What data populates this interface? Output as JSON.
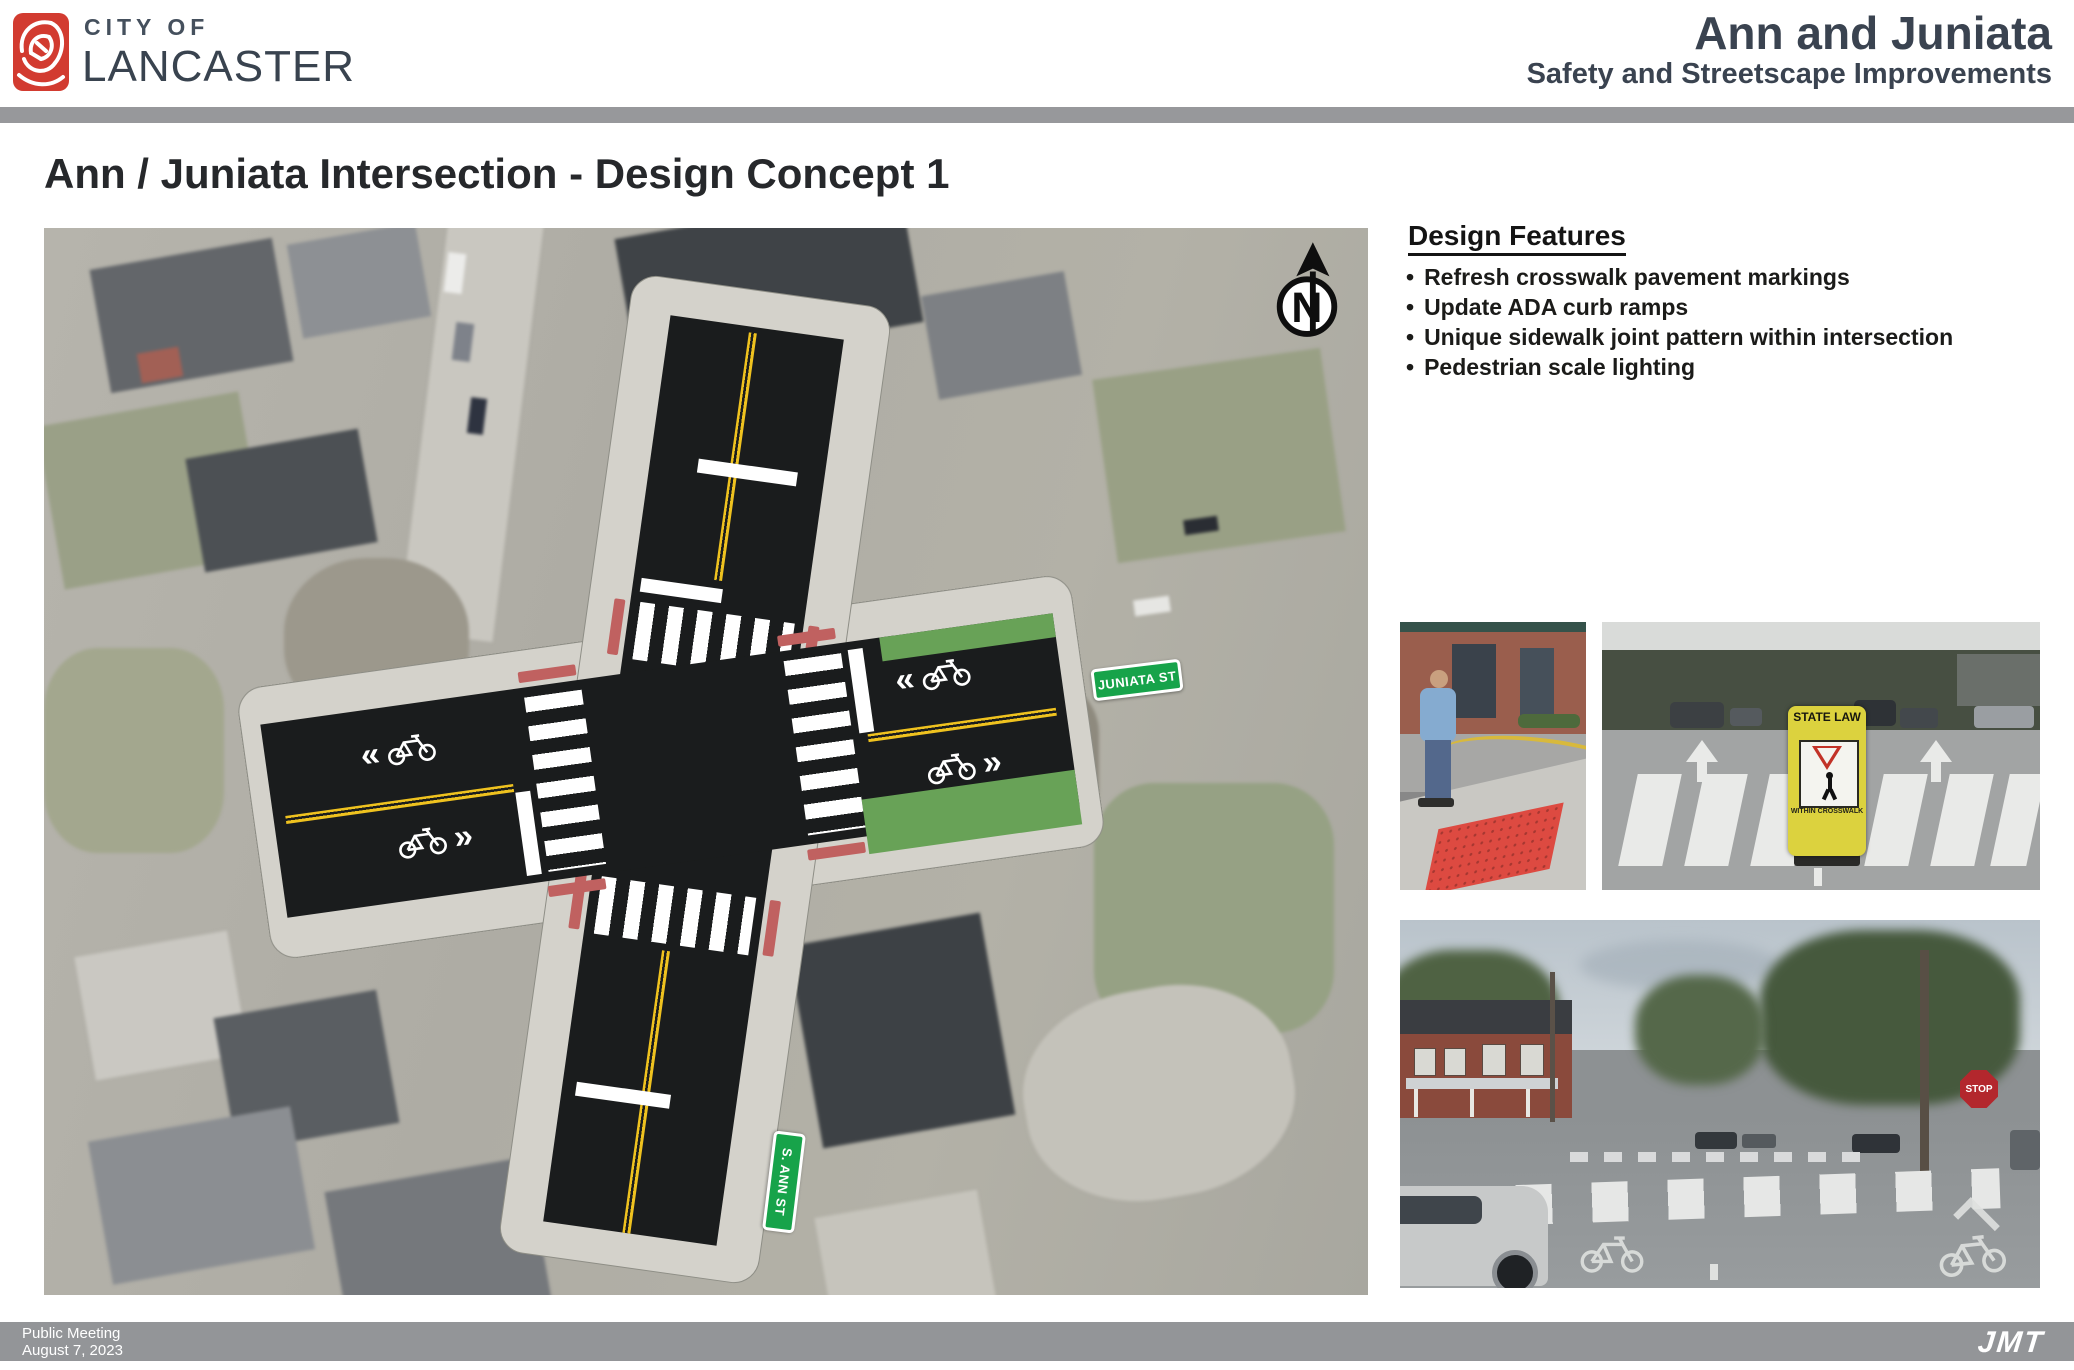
{
  "header": {
    "brand": {
      "line1": "CITY OF",
      "line2": "LANCASTER",
      "logo_icon": "lancaster-rose-logo",
      "logo_red": "#d23b30"
    },
    "title": "Ann and Juniata",
    "subtitle": "Safety and Streetscape Improvements"
  },
  "page_title": "Ann / Juniata Intersection - Design Concept 1",
  "map": {
    "north_label": "N",
    "signs": {
      "east_west_street": "JUNIATA ST",
      "north_south_street": "S. ANN ST"
    },
    "chevrons": {
      "left": "«",
      "right": "»"
    },
    "icons": {
      "north_arrow": "north-arrow-icon",
      "bike_sharrow": "bicycle-sharrow-icon",
      "crosswalk": "continental-crosswalk-marking",
      "curb_ramp": "ada-curb-ramp-marking",
      "curb_extension": "green-curb-extension"
    },
    "colors": {
      "asphalt": "#1a1c1d",
      "lane_yellow": "#efc21f",
      "curb_ramp_red": "#c06160",
      "curb_extension_green": "#68a257",
      "street_sign_green": "#17a34a"
    }
  },
  "design_features": {
    "heading": "Design Features",
    "bullet": "•",
    "items": [
      "Refresh crosswalk pavement markings",
      "Update ADA curb ramps",
      "Unique sidewalk joint pattern within intersection",
      "Pedestrian scale lighting"
    ]
  },
  "photos": {
    "ada_ramp": {
      "name": "ada-curb-ramp-photo"
    },
    "crosswalk_sign": {
      "name": "in-street-pedestrian-sign-photo",
      "sign_top": "STATE LAW",
      "sign_bottom": "WITHIN CROSSWALK"
    },
    "street_view": {
      "name": "intersection-street-view-photo",
      "stop_sign": "STOP"
    }
  },
  "footer": {
    "line1": "Public Meeting",
    "line2": "August 7, 2023",
    "brand": "JMT"
  }
}
